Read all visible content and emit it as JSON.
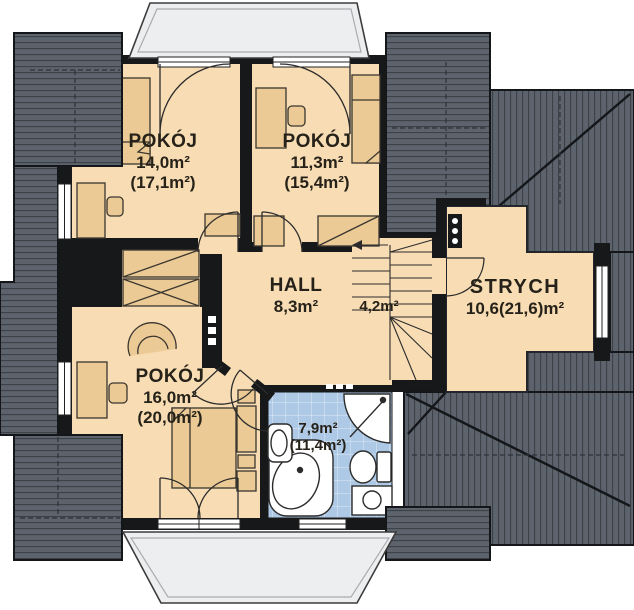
{
  "drawing_type": "floor-plan",
  "rooms": [
    {
      "id": "pokoj-1",
      "name": "POKÓJ",
      "area": "14,0m²",
      "area_in_brackets": "(17,1m²)"
    },
    {
      "id": "pokoj-2",
      "name": "POKÓJ",
      "area": "11,3m²",
      "area_in_brackets": "(15,4m²)"
    },
    {
      "id": "hall",
      "name": "HALL",
      "area": "8,3m²",
      "area_in_brackets": ""
    },
    {
      "id": "staircase",
      "name": "",
      "area": "4,2m²",
      "area_in_brackets": ""
    },
    {
      "id": "pokoj-3",
      "name": "POKÓJ",
      "area": "16,0m²",
      "area_in_brackets": "(20,0m²)"
    },
    {
      "id": "bathroom",
      "name": "",
      "area": "7,9m²",
      "area_in_brackets": "(11,4m²)"
    },
    {
      "id": "strych",
      "name": "STRYCH",
      "area": "10,6(21,6)m²",
      "area_in_brackets": ""
    }
  ],
  "colors": {
    "wall": "#17181a",
    "floor": "#f8ddb4",
    "furniture": "#ecca95",
    "bathroom_floor": "#aec9e5",
    "roof": "#5c636c",
    "roof_line": "#3b4047",
    "balcony": "#edeef0",
    "window": "#ffffff"
  }
}
